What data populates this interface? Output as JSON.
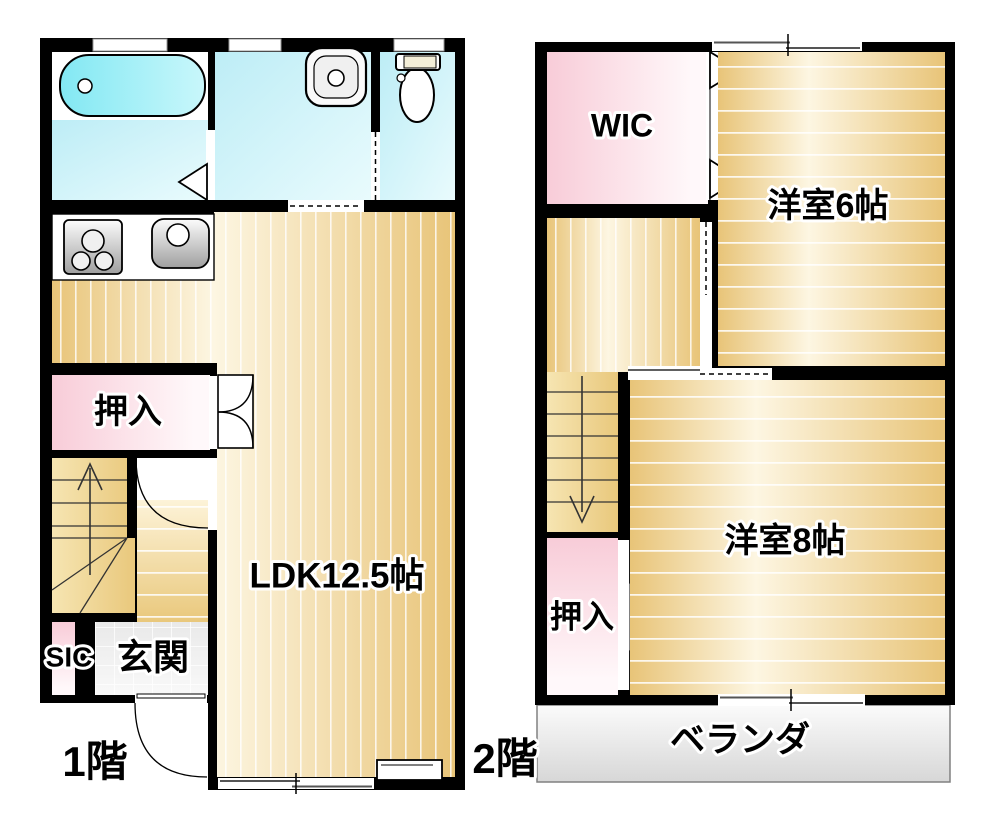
{
  "floor1": {
    "label": "1階",
    "rooms": {
      "ldk": "LDK12.5帖",
      "oshiire": "押入",
      "genkan": "玄関",
      "sic": "SIC"
    }
  },
  "floor2": {
    "label": "2階",
    "rooms": {
      "wic": "WIC",
      "yoshitsu6": "洋室6帖",
      "yoshitsu8": "洋室8帖",
      "oshiire": "押入",
      "veranda": "ベランダ"
    }
  },
  "colors": {
    "wall": "#000000",
    "wood": "#e8c478",
    "wood_light": "#fdf6e2",
    "closet_pink": "#f8ccd8",
    "wet_room_cyan": "#bdedf6",
    "bathtub_cyan": "#82e8f3",
    "entry_tile_gray": "#ededed",
    "veranda_gray": "#e3e3e3"
  }
}
